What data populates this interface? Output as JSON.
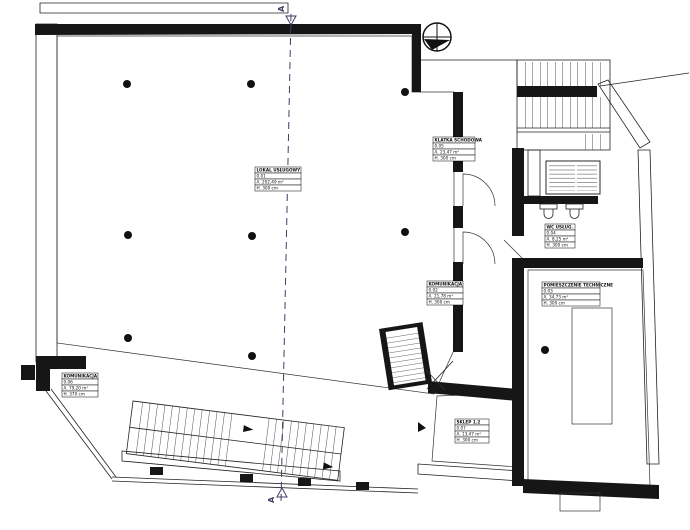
{
  "colors": {
    "wall": "#161616",
    "cream": "#f6efdf",
    "gray": "#eaeae4",
    "pink": "#f8e3e8",
    "section": "#433a66"
  },
  "section": {
    "label": "A"
  },
  "rooms": [
    {
      "name": "LOKAL USŁUGOWY",
      "number": "0.01",
      "area": "A. 202,49 m²",
      "height": "H. 300 cm"
    },
    {
      "name": "KOMUNIKACJA",
      "number": "0.02",
      "area": "A. 21,78 m²",
      "height": "H. 300 cm"
    },
    {
      "name": "POMIESZCZENIE TECHNICZNE",
      "number": "0.03",
      "area": "A. 34,73 m²",
      "height": "H. 300 cm"
    },
    {
      "name": "WC USŁUG.",
      "number": "0.04",
      "area": "A. 8,25 m²",
      "height": "H. 300 cm"
    },
    {
      "name": "KLATKA SCHODOWA",
      "number": "0.05",
      "area": "A. 23,47 m²",
      "height": "H. 300 cm"
    },
    {
      "name": "KOMUNIKACJA",
      "number": "0.06",
      "area": "A. 79,20 m²",
      "height": "H. 370 cm"
    },
    {
      "name": "SKLEP 1.2",
      "number": "0.07",
      "area": "A. 13,47 m²",
      "height": "H. 300 cm"
    }
  ]
}
